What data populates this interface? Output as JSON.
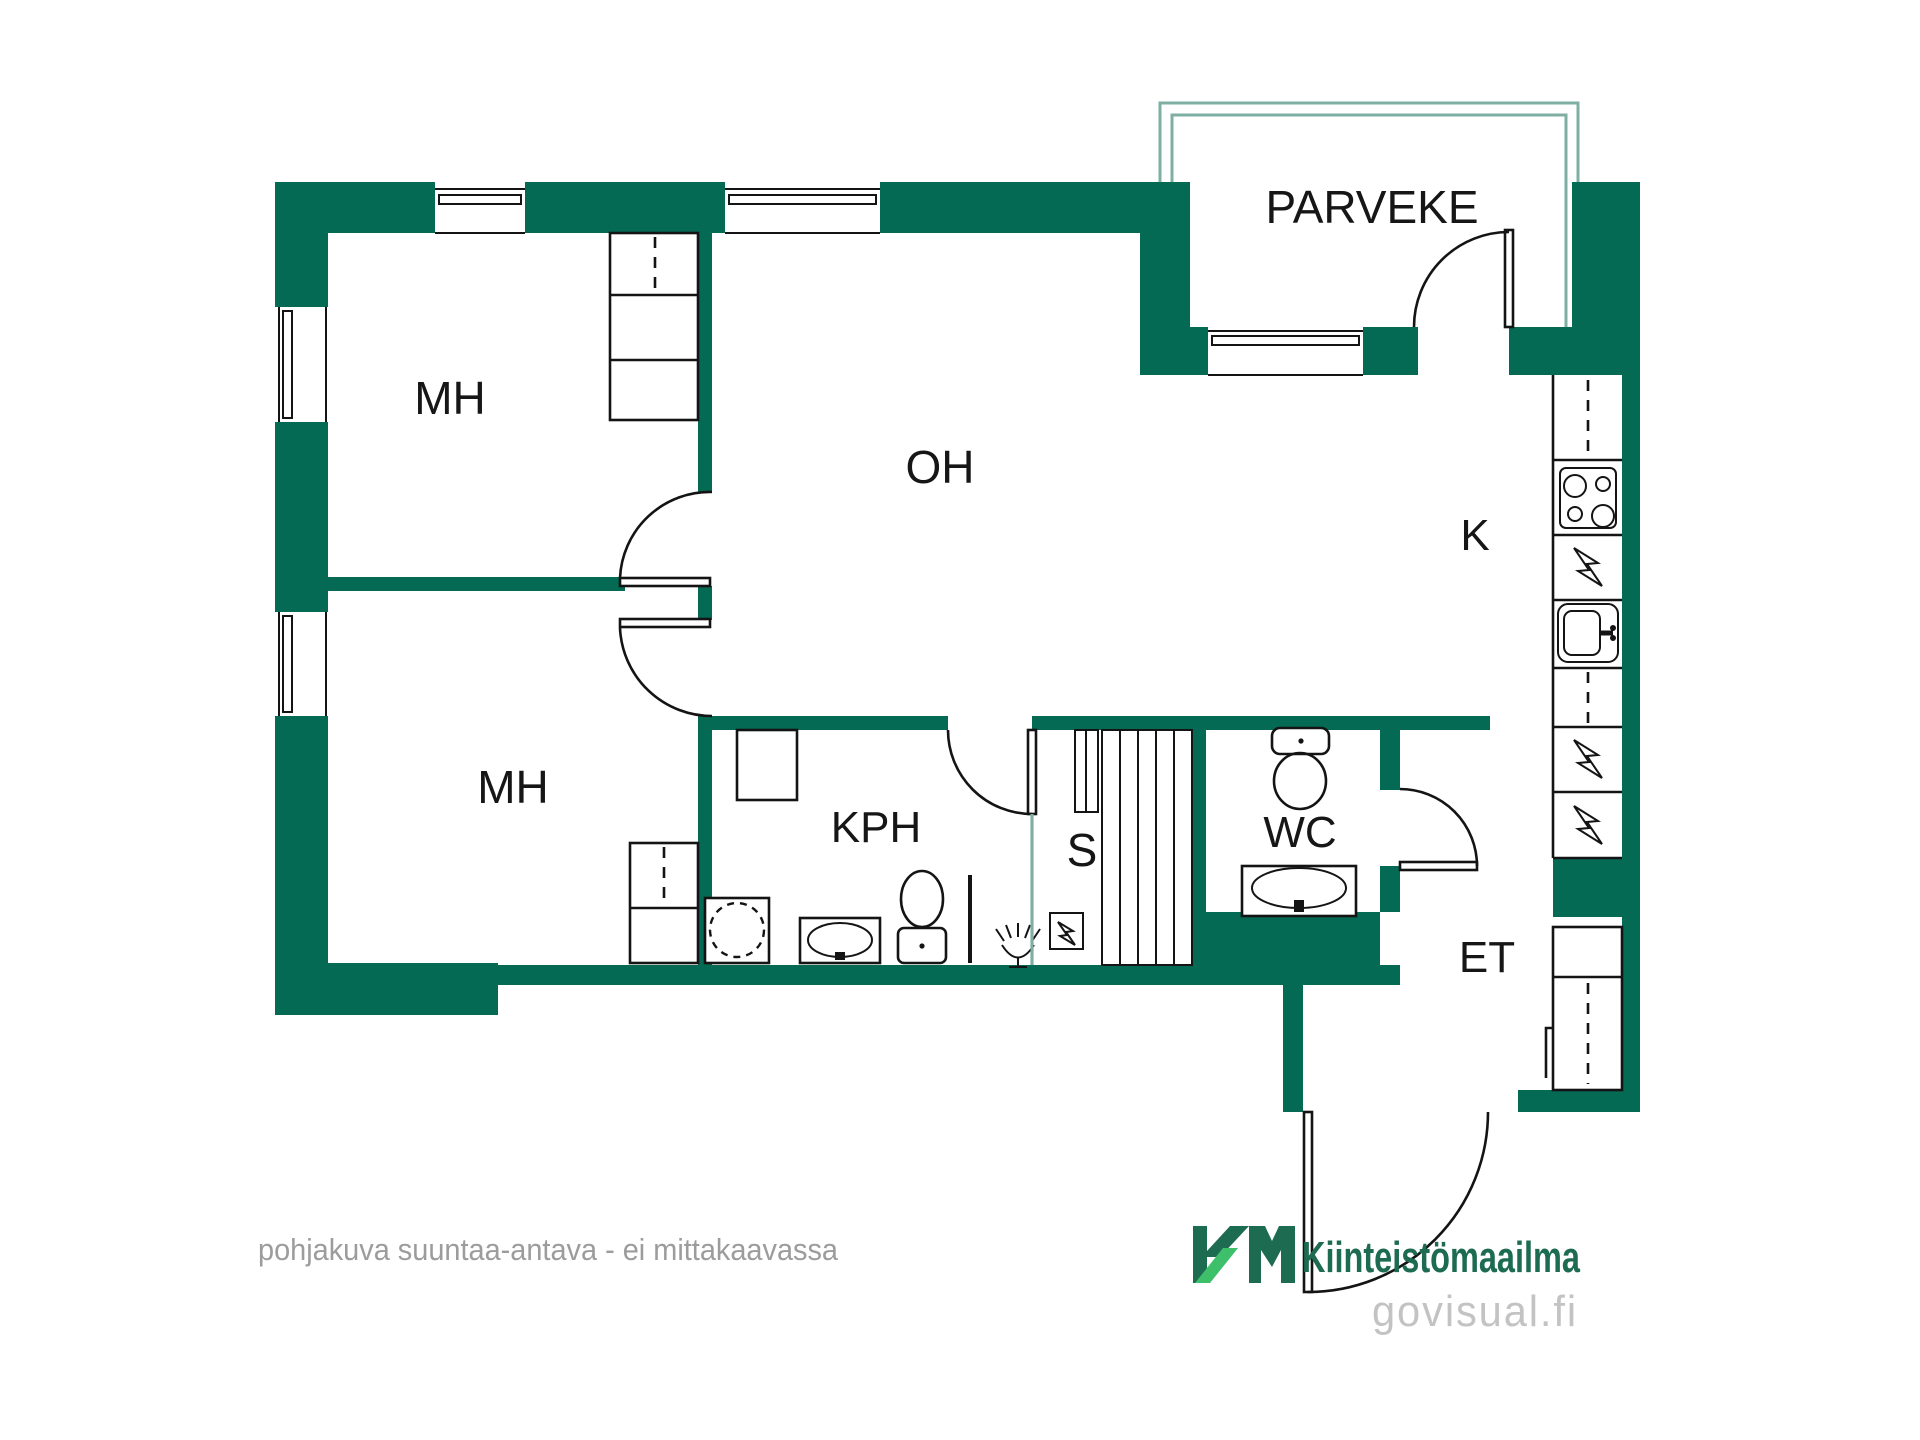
{
  "document": {
    "kind": "apartment-floor-plan"
  },
  "colors": {
    "wall": "#056A53",
    "balcony_frame": "#7FAFA3",
    "line": "#141414",
    "caption": "#9C9C9C",
    "logo_dark": "#1D6B50",
    "logo_light": "#3EC06B",
    "logo_gray": "#C3C3C3",
    "background": "#FFFFFF"
  },
  "rooms": {
    "bedroom1": {
      "label": "MH"
    },
    "bedroom2": {
      "label": "MH"
    },
    "living": {
      "label": "OH"
    },
    "kitchen": {
      "label": "K"
    },
    "bathroom": {
      "label": "KPH"
    },
    "sauna": {
      "label": "S"
    },
    "wc": {
      "label": "WC"
    },
    "entry": {
      "label": "ET"
    },
    "balcony": {
      "label": "PARVEKE"
    }
  },
  "legend": {
    "appliance_symbol": "lightning-bolt"
  },
  "caption": {
    "text": "pohjakuva suuntaa-antava - ei mittakaavassa"
  },
  "branding": {
    "monogram": "KM",
    "company": "Kiinteistömaailma",
    "site": "govisual.fi"
  }
}
